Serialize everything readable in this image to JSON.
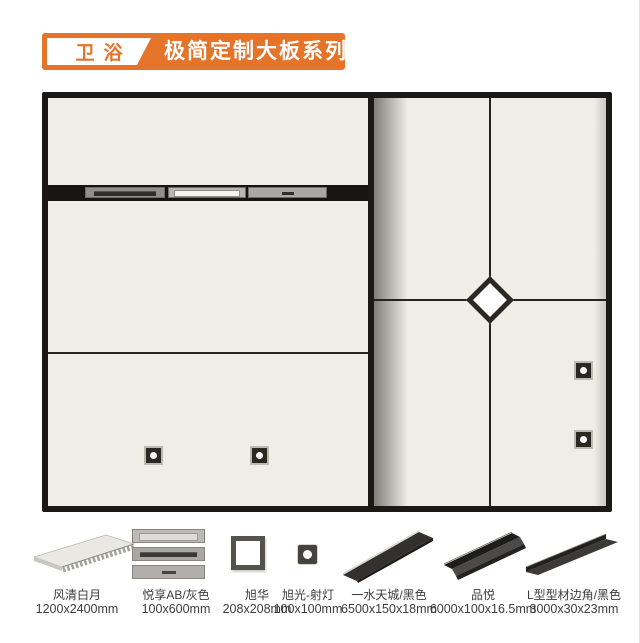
{
  "header": {
    "badge": "卫浴",
    "title": "极简定制大板系列",
    "accent_color": "#E4742A"
  },
  "diagram": {
    "panel_color": "#F0EDE6",
    "frame_color": "#1B1915",
    "left_section": {
      "spotlight_count": 2
    },
    "right_section": {
      "spotlight_count": 2,
      "has_diamond_inlay": true
    }
  },
  "products": [
    {
      "name": "风清白月",
      "size": "1200x2400mm"
    },
    {
      "name": "悦享AB/灰色",
      "size": "100x600mm"
    },
    {
      "name": "旭华",
      "size": "208x208mm"
    },
    {
      "name": "旭光-射灯",
      "size": "100x100mm"
    },
    {
      "name": "一水天城/黑色",
      "size": "6500x150x18mm"
    },
    {
      "name": "品悦",
      "size": "6000x100x16.5mm"
    },
    {
      "name": "L型型材边角/黑色",
      "size": "3000x30x23mm"
    }
  ]
}
